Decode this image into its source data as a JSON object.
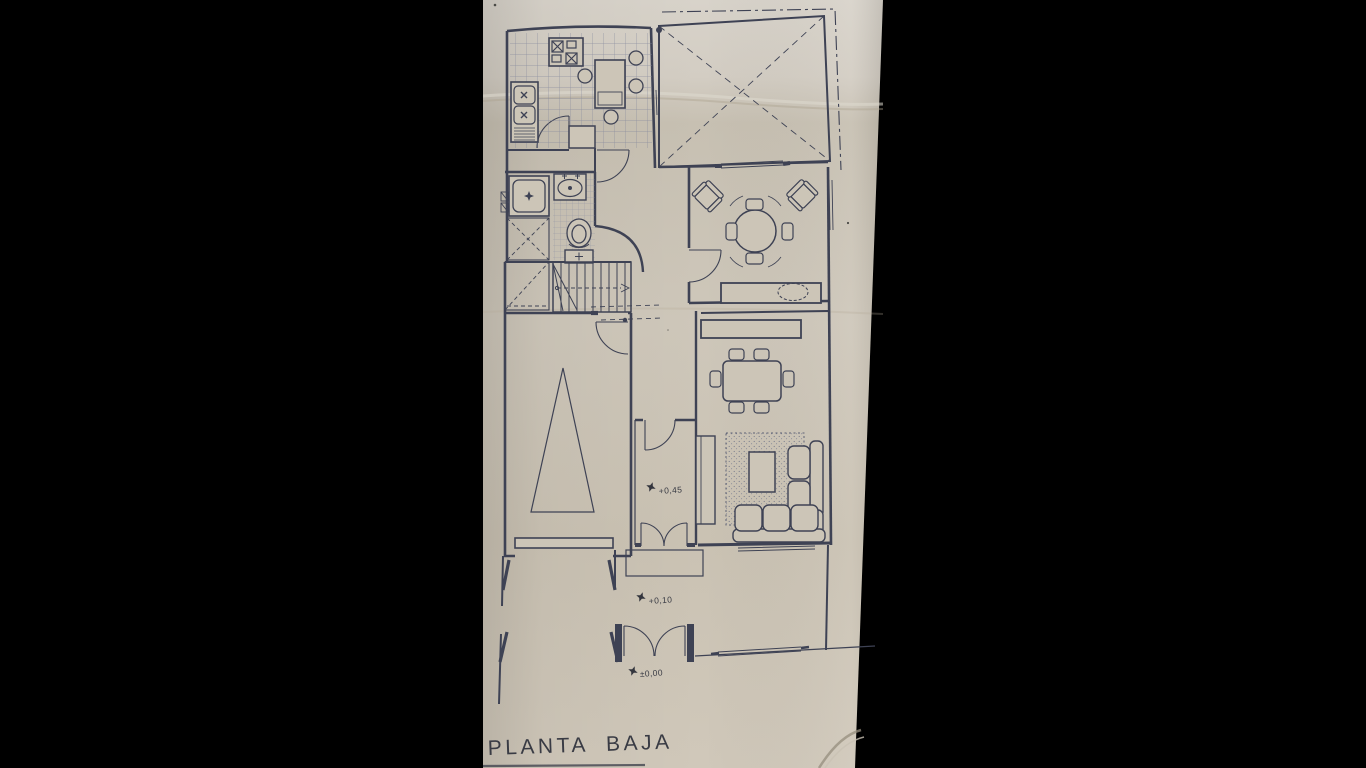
{
  "scene": {
    "description": "Photographed architectural ground-floor plan on beige paper, black letterbox bars left and right",
    "title": "PLANTA BAJA",
    "level_markers": [
      {
        "id": "porch",
        "label": "+0,45"
      },
      {
        "id": "front-yard",
        "label": "+0,10"
      },
      {
        "id": "entrance",
        "label": "±0,00"
      }
    ],
    "colors": {
      "letterbox": "#000000",
      "paper": "#ccc5b7",
      "paper_light": "#d8d3ca",
      "paper_shadow": "#a99f8d",
      "ink": "#3e4254",
      "ink_light": "#6a6e80",
      "grid": "#81859a",
      "text": "#393b44"
    }
  }
}
